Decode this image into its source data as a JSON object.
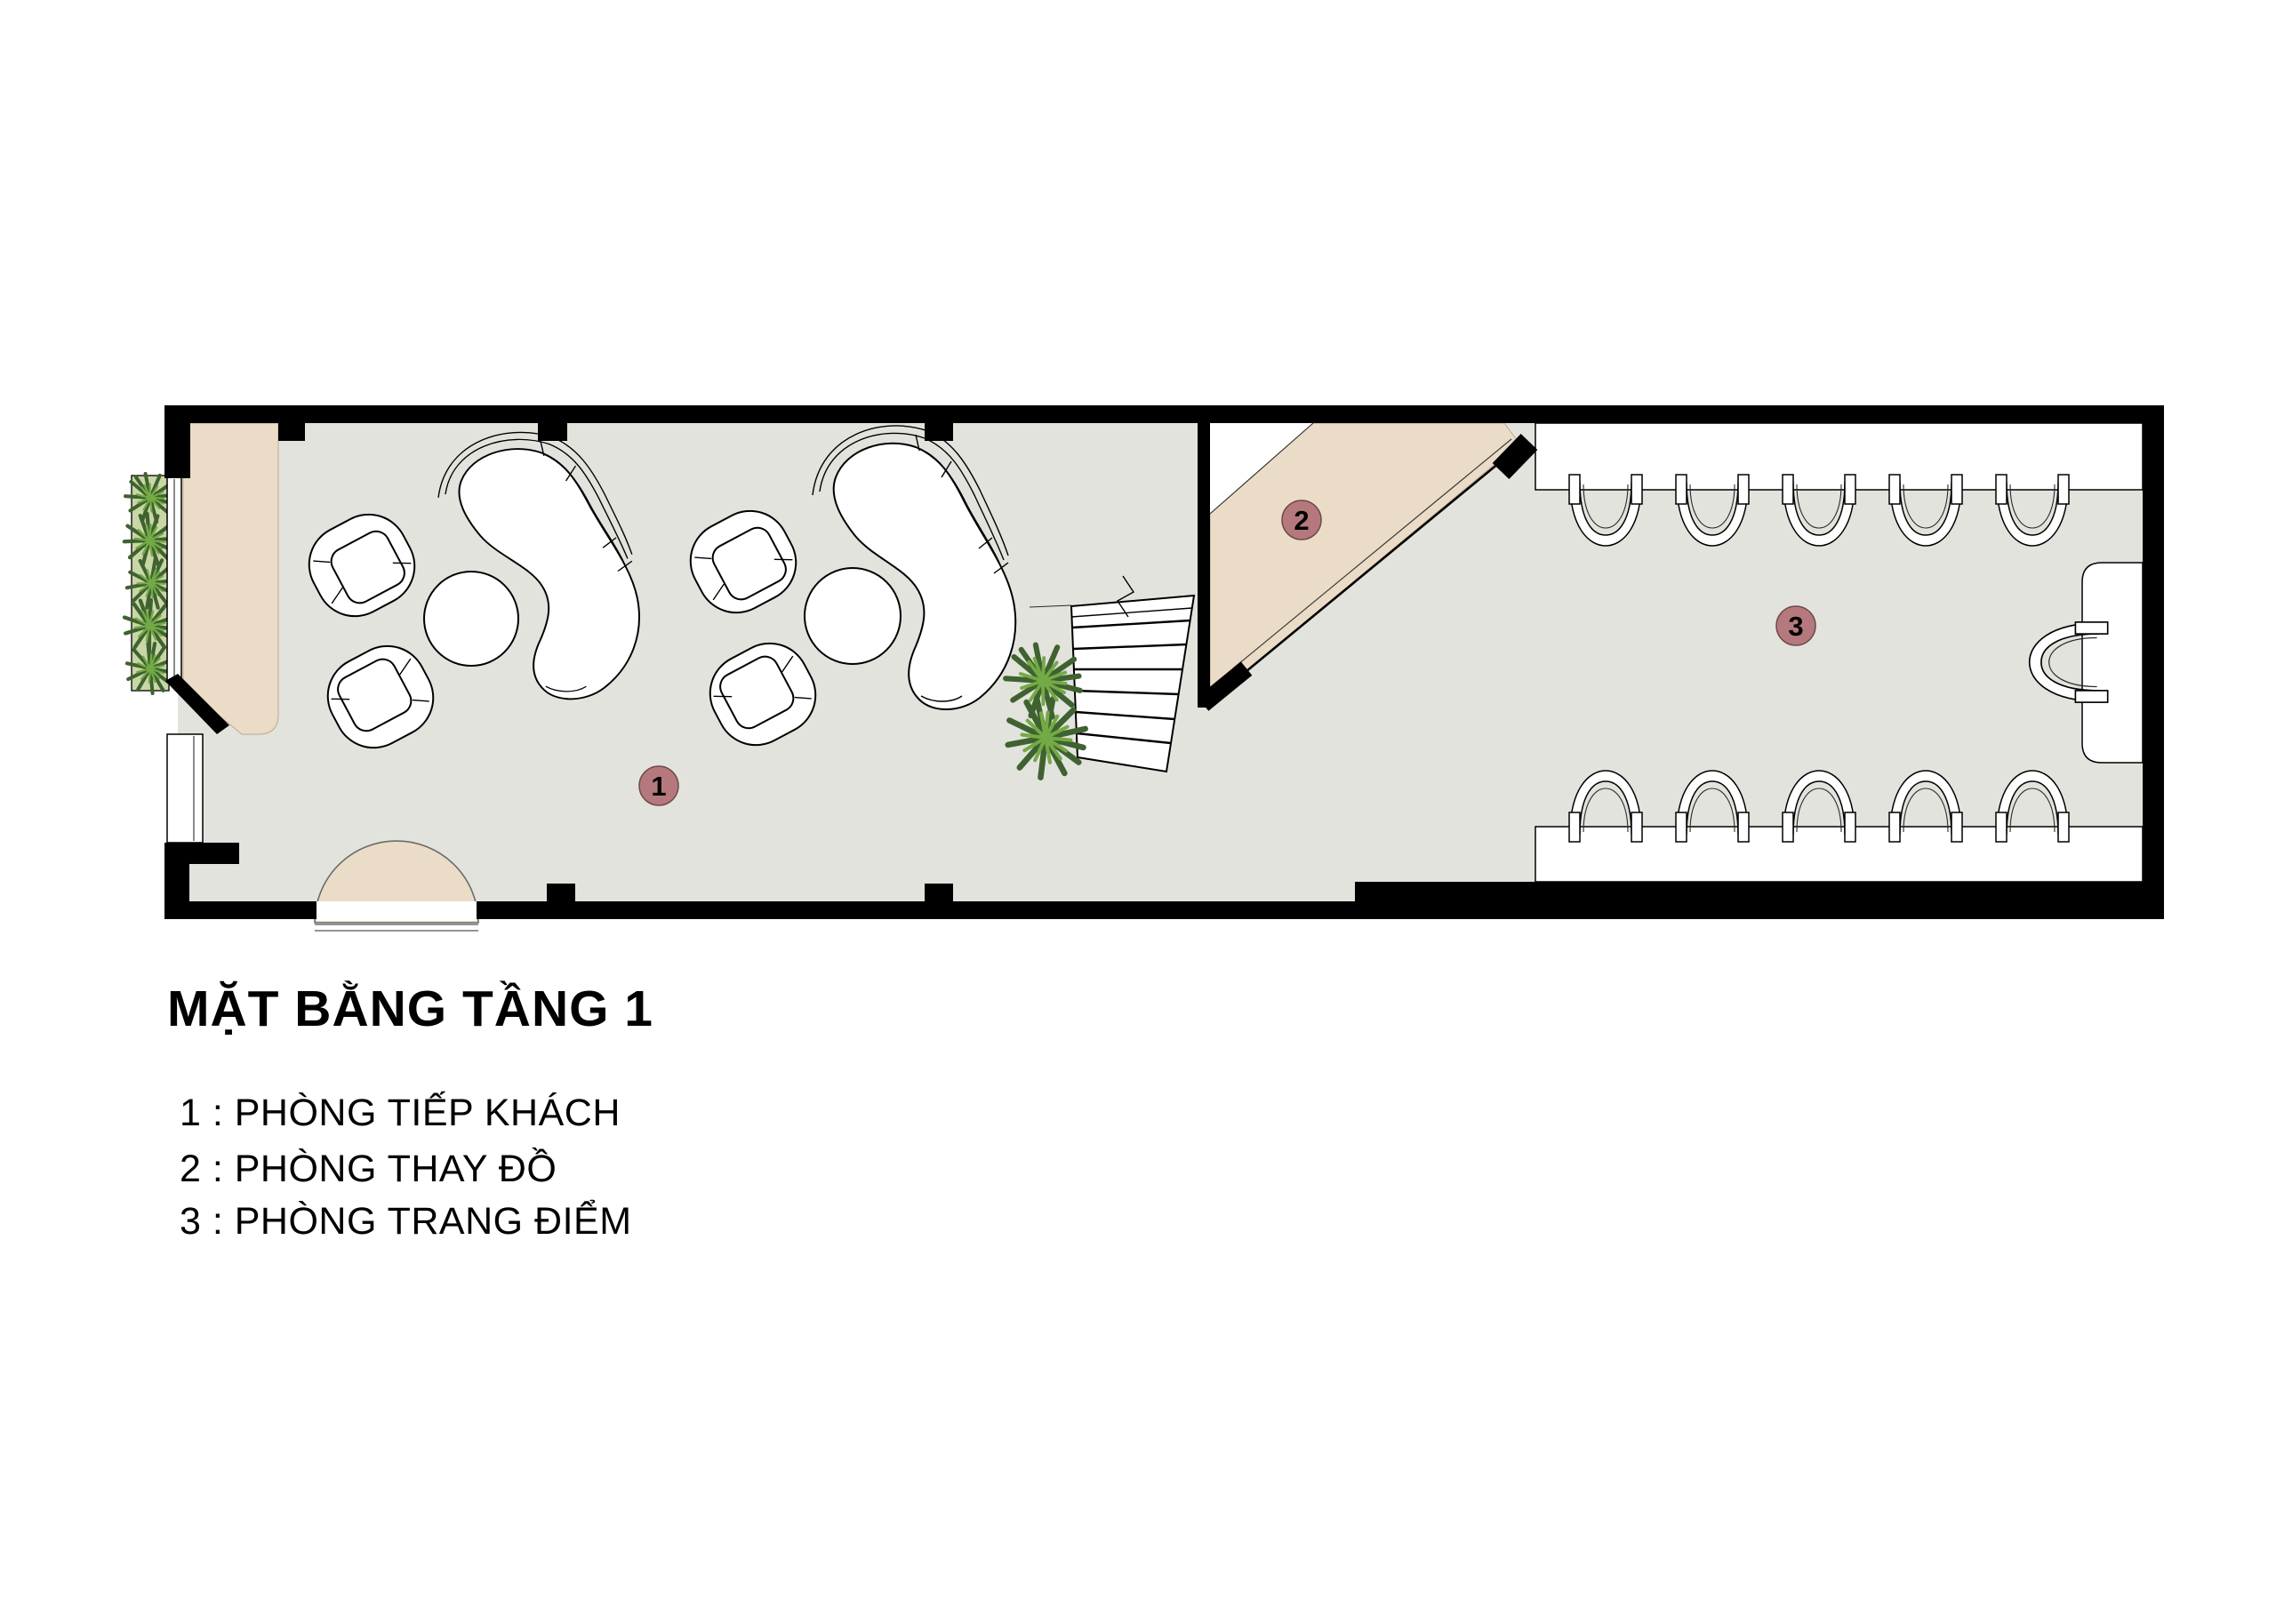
{
  "title": "MẶT BẰNG TẦNG 1",
  "legend": {
    "items": [
      "1 : PHÒNG TIẾP KHÁCH",
      "2 : PHÒNG THAY ĐỒ",
      "3 : PHÒNG TRANG ĐIỂM"
    ]
  },
  "rooms": [
    {
      "number": "1",
      "name": "PHÒNG TIẾP KHÁCH"
    },
    {
      "number": "2",
      "name": "PHÒNG THAY ĐỒ"
    },
    {
      "number": "3",
      "name": "PHÒNG TRANG ĐIỂM"
    }
  ],
  "colors": {
    "wall": "#000000",
    "floor": "#e2e3dd",
    "accent_beige": "#ebdcc7",
    "room_label": "#b5797d",
    "planter_bed": "#c9d6a6",
    "plant_dark": "#3f6230",
    "plant_light": "#74aa45"
  }
}
